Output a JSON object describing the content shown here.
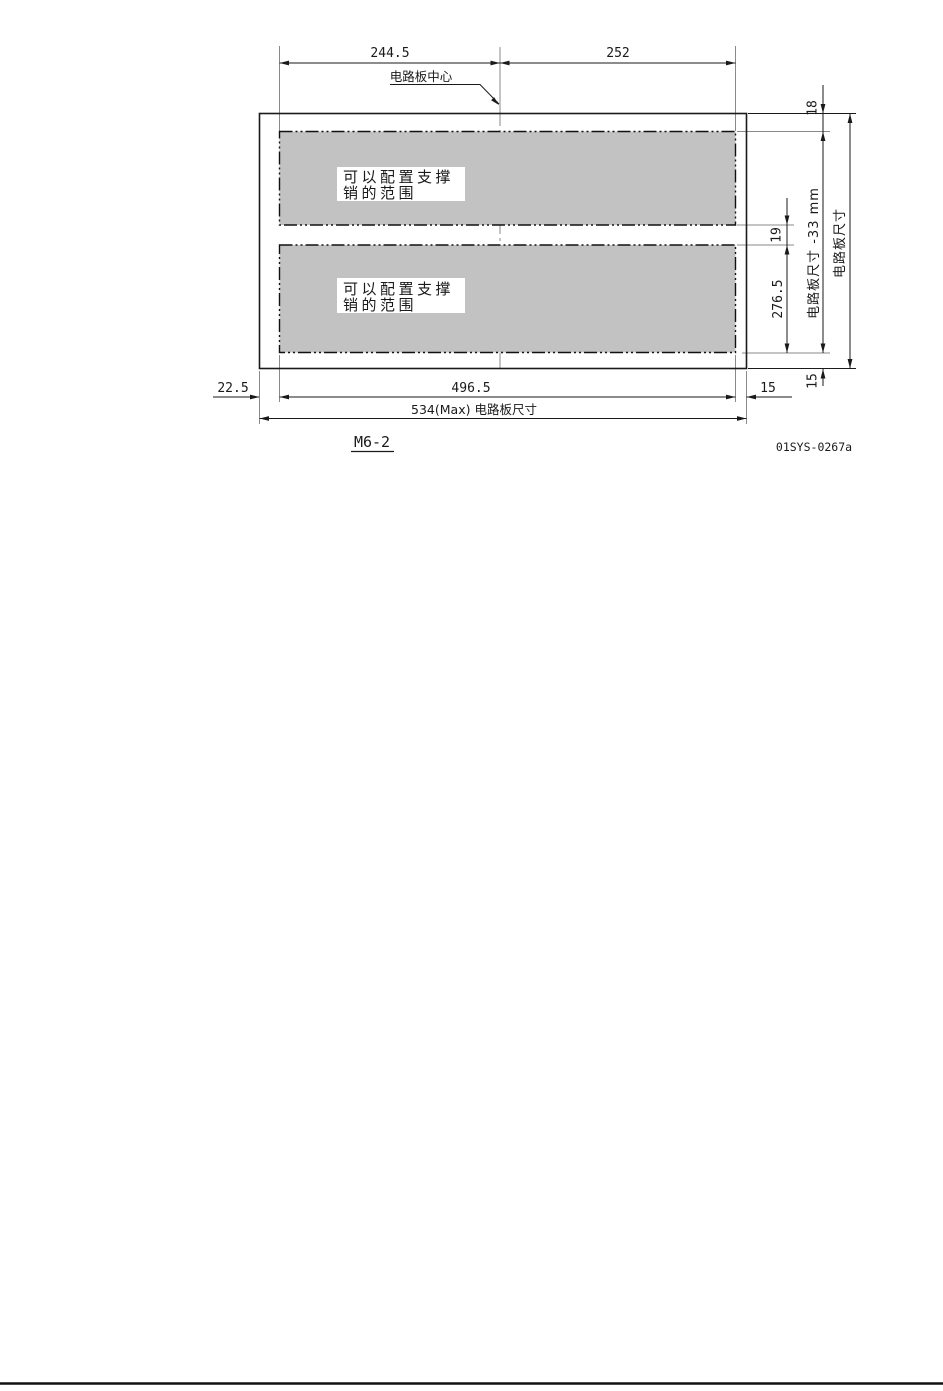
{
  "page": {
    "figure_label": "M6-2",
    "drawing_number": "01SYS-0267a"
  },
  "diagram": {
    "center_callout": "电路板中心",
    "region_top": {
      "label_line1": "可以配置支撑",
      "label_line2": "销的范围"
    },
    "region_bottom": {
      "label_line1": "可以配置支撑",
      "label_line2": "销的范围"
    },
    "dimensions": {
      "center_to_left": "244.5",
      "center_to_right": "252",
      "top_margin": "18",
      "region_gap": "19",
      "lower_span": "276.5",
      "regions_vertical_extent": "电路板尺寸 -33 mm",
      "board_height": "电路板尺寸",
      "bottom_margin": "15",
      "left_margin": "22.5",
      "regions_width": "496.5",
      "right_margin": "15",
      "board_width_max": "534(Max) 电路板尺寸"
    },
    "colors": {
      "region_fill": "#c2c2c2",
      "line": "#1a1a1a",
      "aux_line": "#8a8a8a"
    }
  }
}
